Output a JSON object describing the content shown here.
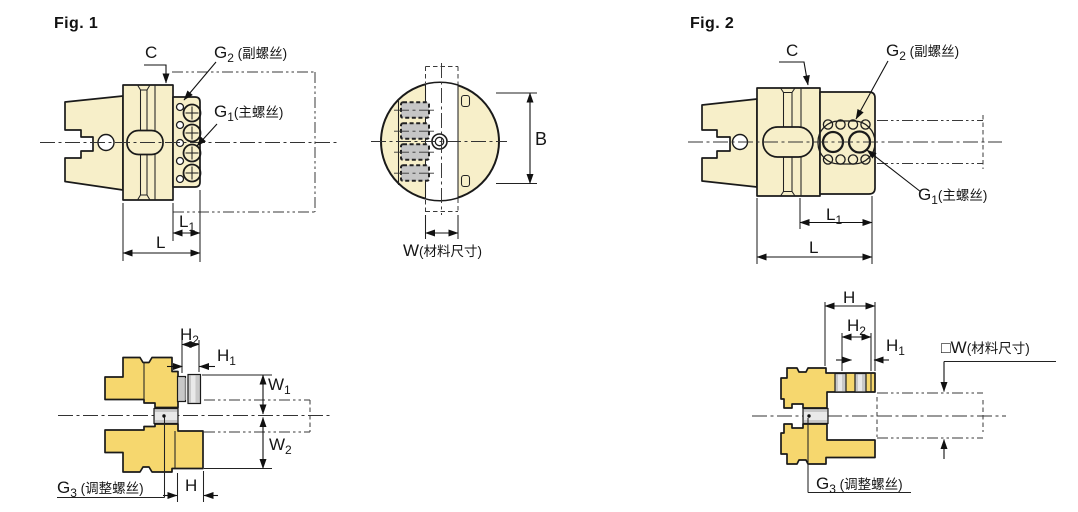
{
  "colors": {
    "outline": "#1a1a1a",
    "body_light": "#f7efc9",
    "body_gold": "#f6d76e",
    "screw_gray": "#c8c8c8",
    "background": "#ffffff"
  },
  "figure1": {
    "title": "Fig. 1",
    "labels": {
      "c": "C",
      "l": "L",
      "b": "B",
      "h": "H",
      "l1_main": "L",
      "l1_sub": "1",
      "g2_main": "G",
      "g2_sub": "2",
      "g2_text": " (副螺丝)",
      "g1_main": "G",
      "g1_sub": "1",
      "g1_text": "(主螺丝)",
      "g3_main": "G",
      "g3_sub": "3",
      "g3_text": " (调整螺丝)",
      "w_main": "W",
      "w_text": "(材料尺寸)",
      "h2_main": "H",
      "h2_sub": "2",
      "h1_main": "H",
      "h1_sub": "1",
      "w1_main": "W",
      "w1_sub": "1",
      "w2_main": "W",
      "w2_sub": "2"
    }
  },
  "figure2": {
    "title": "Fig. 2",
    "labels": {
      "c": "C",
      "l": "L",
      "h": "H",
      "l1_main": "L",
      "l1_sub": "1",
      "g2_main": "G",
      "g2_sub": "2",
      "g2_text": " (副螺丝)",
      "g1_main": "G",
      "g1_sub": "1",
      "g1_text": "(主螺丝)",
      "g3_main": "G",
      "g3_sub": "3",
      "g3_text": " (调整螺丝)",
      "w_prefix": "□",
      "w_main": "W",
      "w_text": "(材料尺寸)",
      "h2_main": "H",
      "h2_sub": "2",
      "h1_main": "H",
      "h1_sub": "1"
    }
  }
}
